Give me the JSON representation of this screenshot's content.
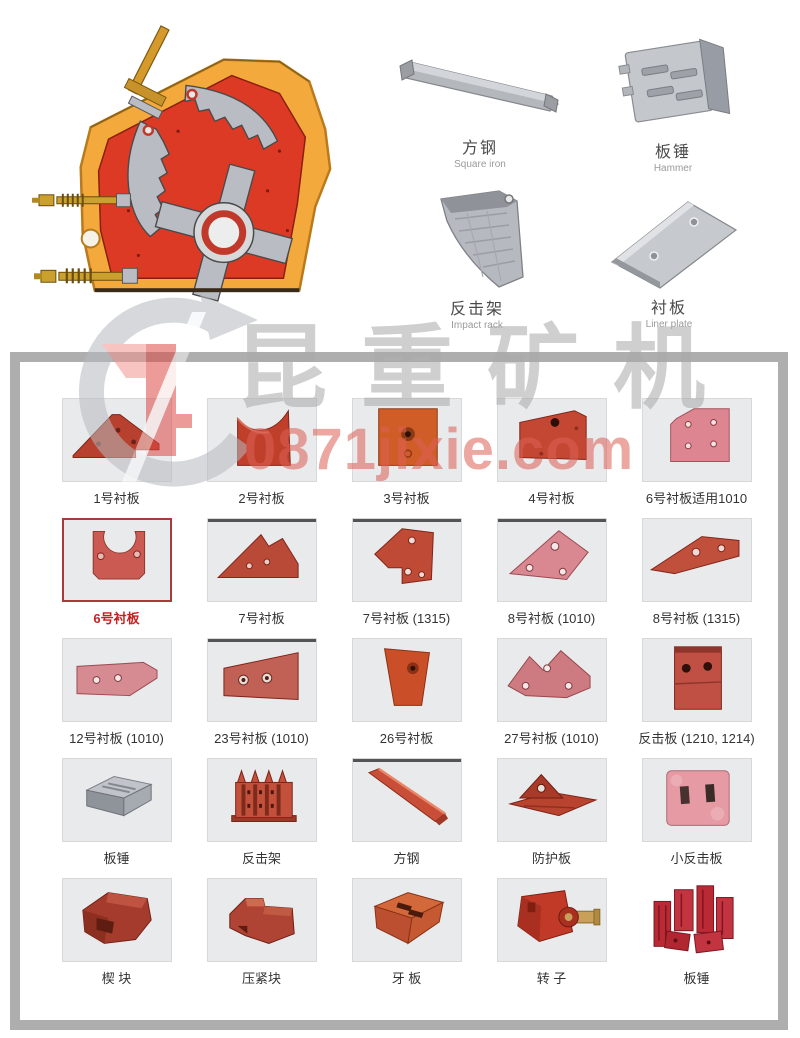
{
  "watermark": {
    "brand_text": "昆重矿机",
    "site_text": "0871jixie.com"
  },
  "top_parts": [
    {
      "zh": "方钢",
      "en": "Square iron"
    },
    {
      "zh": "板锤",
      "en": "Hammer"
    },
    {
      "zh": "反击架",
      "en": "Impact rack"
    },
    {
      "zh": "衬板",
      "en": "Liner plate"
    }
  ],
  "colors": {
    "highlight_border": "#a93a3a",
    "highlight_text": "#c42222",
    "casing_orange": "#f4a93c",
    "body_red": "#dd3a26",
    "metal_gray": "#b9bdc3"
  },
  "grid": {
    "rows": [
      [
        "1号衬板",
        "2号衬板",
        "3号衬板",
        "4号衬板",
        "6号衬板适用1010"
      ],
      [
        "6号衬板",
        "7号衬板",
        "7号衬板 (1315)",
        "8号衬板 (1010)",
        "8号衬板 (1315)"
      ],
      [
        "12号衬板 (1010)",
        "23号衬板 (1010)",
        "26号衬板",
        "27号衬板 (1010)",
        "反击板 (1210, 1214)"
      ],
      [
        "板锤",
        "反击架",
        "方钢",
        "防护板",
        "小反击板"
      ],
      [
        "楔 块",
        "压紧块",
        "牙 板",
        "转 子",
        "板锤"
      ]
    ]
  }
}
